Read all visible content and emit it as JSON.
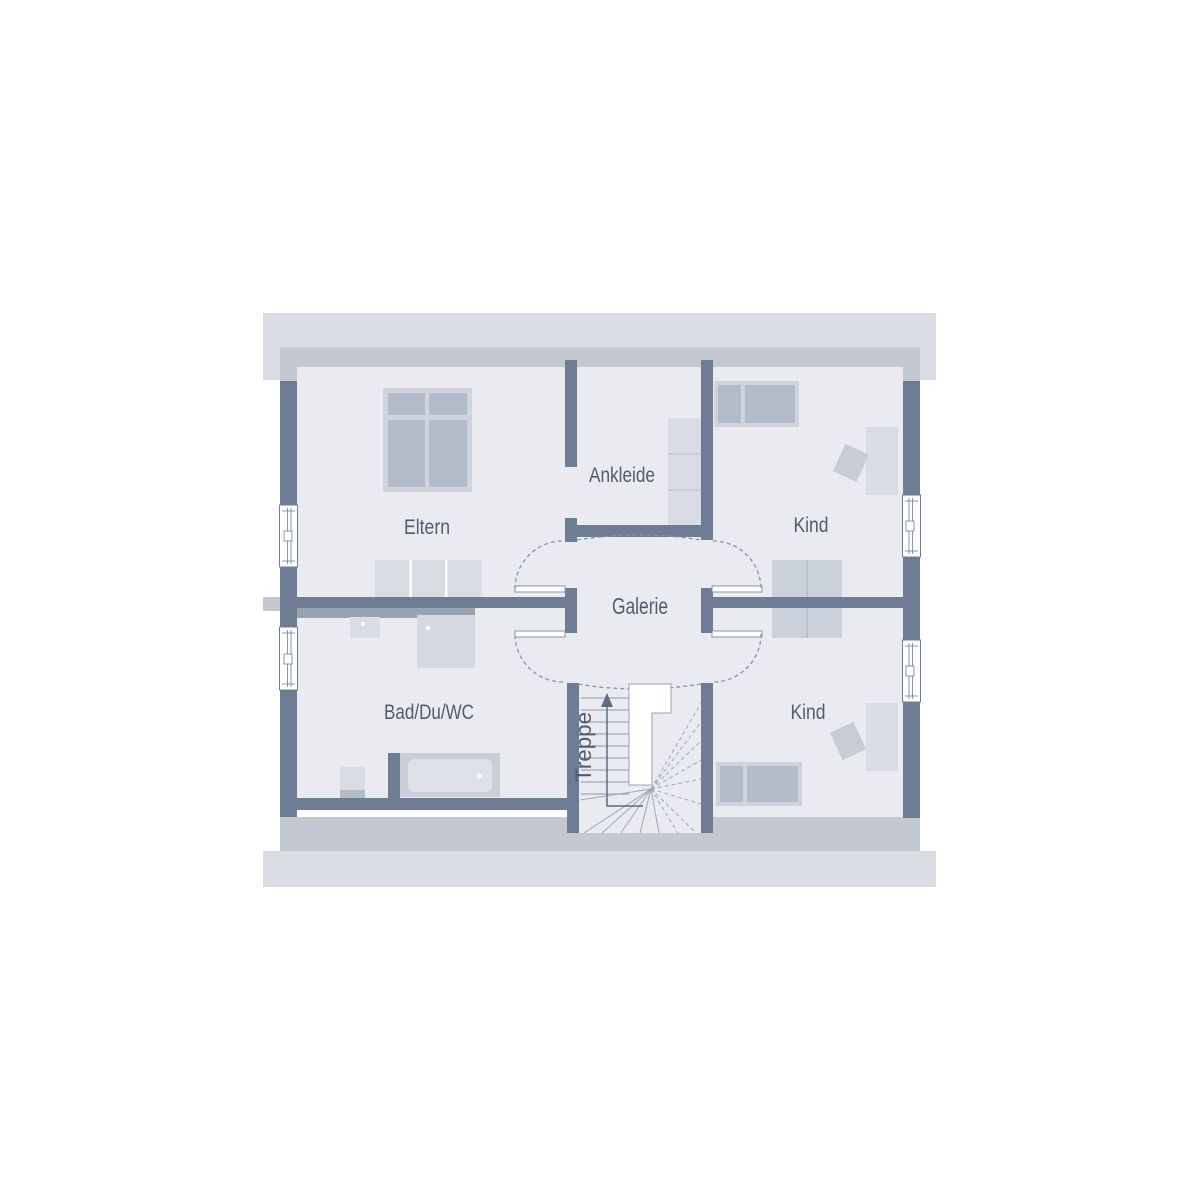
{
  "plan": {
    "rooms": [
      {
        "name": "Eltern"
      },
      {
        "name": "Ankleide"
      },
      {
        "name": "Kind"
      },
      {
        "name": "Galerie"
      },
      {
        "name": "Kind"
      },
      {
        "name": "Bad/Du/WC"
      },
      {
        "name": "Treppe"
      }
    ],
    "colors": {
      "background": "#ffffff",
      "roof_overhang": "#d9dce2",
      "knee_wall": "#c3c8d1",
      "floor": "#e9ebf0",
      "wall": "#6f7d94",
      "furniture_light": "#d9dce3",
      "furniture_mid": "#b5bcc9",
      "bed_frame": "#cfd4dc",
      "desk": "#cbd1da",
      "counter": "#9aa3b2",
      "dash_line": "#8b94a5",
      "stair_line": "#a0a8b6",
      "label_text": "#525c6e"
    }
  }
}
